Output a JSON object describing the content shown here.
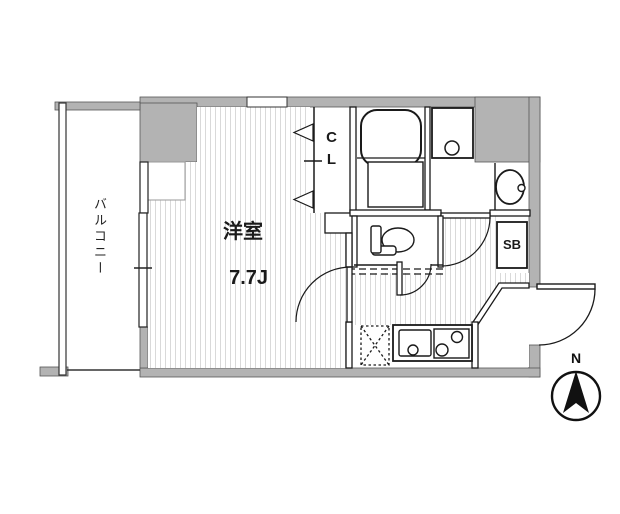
{
  "floor_plan": {
    "balcony_label": "バルコニー",
    "room_name": "洋室",
    "room_size": "7.7J",
    "closet_label": "CL",
    "shoe_box_label": "SB",
    "compass_label": "N",
    "colors": {
      "wall_fill": "#b3b3b3",
      "line_color": "#1a1a1a",
      "hatch_color": "#d9d9d9"
    },
    "fixtures": [
      "bathtub",
      "washing-machine-pan",
      "wash-basin",
      "toilet",
      "kitchen-sink",
      "gas-stove",
      "refrigerator-space",
      "folding-closet-door",
      "entrance-door",
      "north-compass"
    ]
  }
}
